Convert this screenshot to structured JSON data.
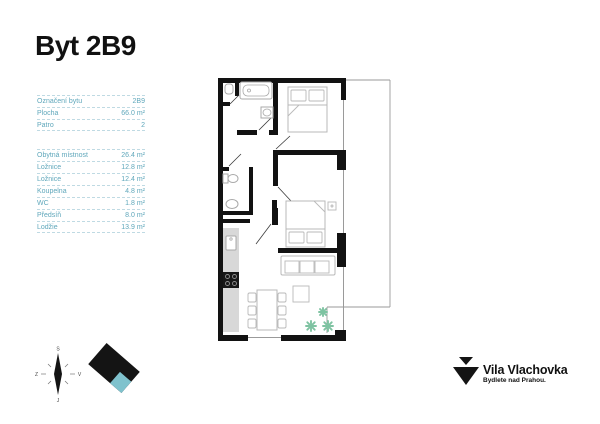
{
  "title": "Byt 2B9",
  "info_table": {
    "rows": [
      {
        "label": "Označení bytu",
        "value": "2B9"
      },
      {
        "label": "Plocha",
        "value": "66.0 m²"
      },
      {
        "label": "Patro",
        "value": "2"
      }
    ]
  },
  "rooms_table": {
    "rows": [
      {
        "label": "Obytná místnost",
        "value": "26.4 m²"
      },
      {
        "label": "Ložnice",
        "value": "12.8 m²"
      },
      {
        "label": "Ložnice",
        "value": "12.4 m²"
      },
      {
        "label": "Koupelna",
        "value": "4.8 m²"
      },
      {
        "label": "WC",
        "value": "1.8 m²"
      },
      {
        "label": "Předsíň",
        "value": "8.0 m²"
      },
      {
        "label": "Lodžie",
        "value": "13.9 m²"
      }
    ]
  },
  "compass": {
    "north_label": "S",
    "south_label": "J",
    "west_label": "Z",
    "east_label": "V"
  },
  "brand": {
    "name": "Vila Vlachovka",
    "tagline": "Bydlete nad Prahou."
  },
  "colors": {
    "table_teal": "#5FA7BB",
    "table_line": "#BFDAE3",
    "wall_black": "#121212",
    "fixture_gray": "#A9A9A9",
    "counter_gray": "#D8D8D8",
    "plant_green": "#7FC3A2",
    "logo_teal": "#7FC2CD"
  }
}
